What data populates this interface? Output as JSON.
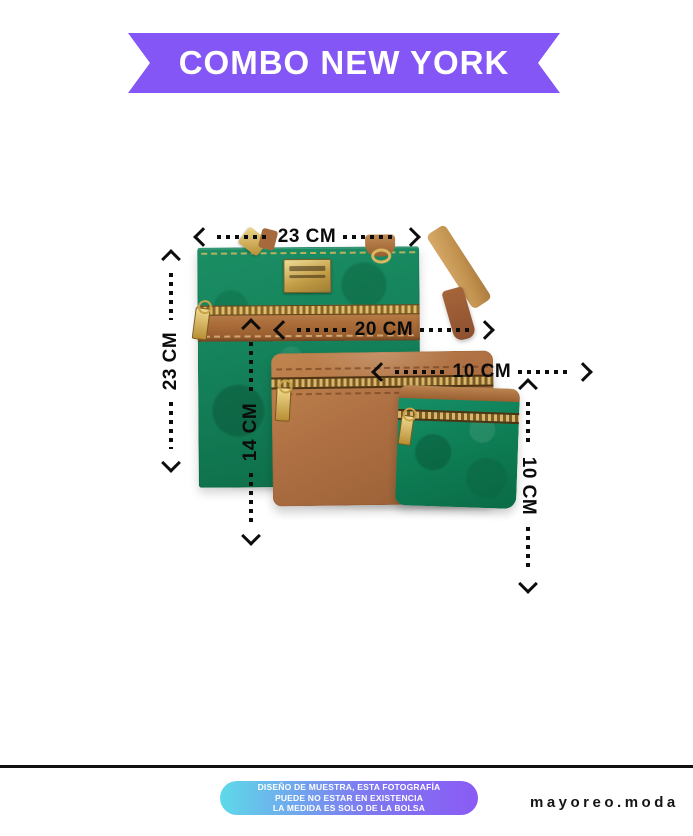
{
  "banner": {
    "title": "COMBO NEW YORK",
    "bg_color": "#8456F5",
    "text_color": "#FFFFFF"
  },
  "dimensions": {
    "bag_width": "23 CM",
    "bag_height": "23 CM",
    "pouch_width": "20 CM",
    "pouch_height": "14 CM",
    "coin_width": "10 CM",
    "coin_height": "10 CM"
  },
  "products": {
    "crossbody_bag_color": "#14815A",
    "trim_color": "#A96B38",
    "brown_pouch_color": "#AD6F42",
    "coin_purse_color": "#0E7E55",
    "hardware_color": "#D9B65F"
  },
  "footer": {
    "disclaimer": [
      "DISEÑO DE MUESTRA, ESTA FOTOGRAFÍA",
      "PUEDE NO ESTAR EN EXISTENCIA",
      "LA MEDIDA ES SOLO DE LA BOLSA"
    ],
    "brand": "mayoreo.moda",
    "pill_gradient_from": "#5FD9E9",
    "pill_gradient_to": "#8A5BF5"
  }
}
